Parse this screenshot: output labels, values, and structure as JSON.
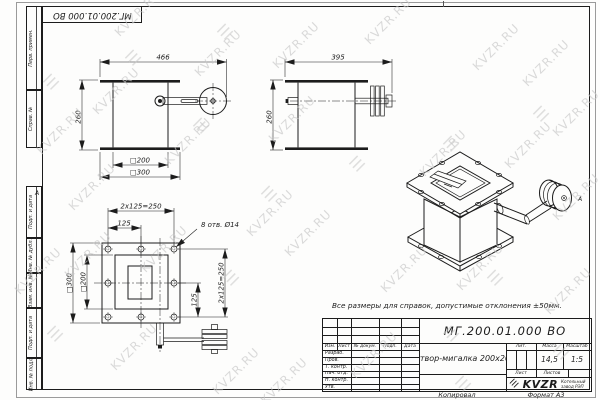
{
  "colors": {
    "line": "#1c1c1c",
    "watermark": "#c7c7c7",
    "paper": "#fdfdfc"
  },
  "watermarks": {
    "text": "KVZR.RU",
    "logo_glyph": "☰",
    "items": [
      {
        "t": "text",
        "x": 30,
        "y": 124
      },
      {
        "t": "text",
        "x": 108,
        "y": 6
      },
      {
        "t": "text",
        "x": 86,
        "y": 84
      },
      {
        "t": "text",
        "x": 158,
        "y": 134
      },
      {
        "t": "text",
        "x": 188,
        "y": 46
      },
      {
        "t": "text",
        "x": 266,
        "y": 38
      },
      {
        "t": "text",
        "x": 262,
        "y": 112
      },
      {
        "t": "text",
        "x": 358,
        "y": 14
      },
      {
        "t": "text",
        "x": 466,
        "y": 40
      },
      {
        "t": "text",
        "x": 516,
        "y": 56
      },
      {
        "t": "text",
        "x": 413,
        "y": 146
      },
      {
        "t": "text",
        "x": 498,
        "y": 138
      },
      {
        "t": "text",
        "x": 62,
        "y": 180
      },
      {
        "t": "text",
        "x": 8,
        "y": 264
      },
      {
        "t": "text",
        "x": 58,
        "y": 248
      },
      {
        "t": "text",
        "x": 134,
        "y": 242
      },
      {
        "t": "text",
        "x": 240,
        "y": 206
      },
      {
        "t": "text",
        "x": 278,
        "y": 226
      },
      {
        "t": "text",
        "x": 374,
        "y": 262
      },
      {
        "t": "text",
        "x": 450,
        "y": 260
      },
      {
        "t": "text",
        "x": 538,
        "y": 284
      },
      {
        "t": "text",
        "x": 104,
        "y": 340
      },
      {
        "t": "text",
        "x": 206,
        "y": 364
      },
      {
        "t": "text",
        "x": 254,
        "y": 374
      },
      {
        "t": "text",
        "x": 344,
        "y": 348
      },
      {
        "t": "text",
        "x": 546,
        "y": 190
      },
      {
        "t": "text",
        "x": 546,
        "y": 106
      },
      {
        "t": "logo",
        "x": 44,
        "y": 72
      },
      {
        "t": "logo",
        "x": 126,
        "y": 48
      },
      {
        "t": "logo",
        "x": 218,
        "y": 22
      },
      {
        "t": "logo",
        "x": 194,
        "y": 116
      },
      {
        "t": "logo",
        "x": 350,
        "y": 154
      },
      {
        "t": "logo",
        "x": 444,
        "y": 134
      },
      {
        "t": "logo",
        "x": 534,
        "y": 104
      },
      {
        "t": "logo",
        "x": 224,
        "y": 268
      },
      {
        "t": "logo",
        "x": 262,
        "y": 184
      },
      {
        "t": "logo",
        "x": 48,
        "y": 324
      },
      {
        "t": "logo",
        "x": 488,
        "y": 268
      },
      {
        "t": "logo",
        "x": 444,
        "y": 324
      },
      {
        "t": "logo",
        "x": 456,
        "y": 374
      },
      {
        "t": "logo",
        "x": 554,
        "y": 342
      }
    ]
  },
  "margin": {
    "zone_letter": "А",
    "items": [
      {
        "label": "Перв. примен."
      },
      {
        "label": "Справ. №"
      },
      {
        "label": "Подп. и дата"
      },
      {
        "label": "Инв. № дубл."
      },
      {
        "label": "Взам. инв. №"
      },
      {
        "label": "Подп. и дата"
      },
      {
        "label": "Инв. № подл."
      }
    ]
  },
  "corner_box": {
    "designation": "МГ.200.01.000 ВО"
  },
  "note": "Все размеры для справок, допустимые отклонения ±50мм.",
  "views": {
    "front": {
      "dim_total_width": "466",
      "dim_height": "260",
      "dim_inner": "□200",
      "dim_outer": "□300"
    },
    "side": {
      "dim_total_width": "395",
      "dim_height": "260"
    },
    "flange": {
      "dim_bolt_row": "2x125=250",
      "dim_bolt_half": "125",
      "holes_note": "8 отв. Ø14",
      "dim_outer": "□300",
      "dim_inner": "□200",
      "dim_bolt_half_v": "125",
      "dim_bolt_col": "2x125=250"
    }
  },
  "title_block": {
    "designation": "МГ.200.01.000 ВО",
    "name": "Затвор-мигалка 200x200",
    "columns": {
      "izm": "Изм.",
      "list": "Лист",
      "doc": "№ докум.",
      "sign": "Подп.",
      "date": "Дата"
    },
    "rows": [
      {
        "label": "Разраб."
      },
      {
        "label": "Пров."
      },
      {
        "label": "Т. контр."
      },
      {
        "label": "Нач. отд."
      },
      {
        "label": "Н. контр."
      },
      {
        "label": "Утв."
      }
    ],
    "lit_label": "Лит.",
    "mass_label": "Масса",
    "scale_label": "Масштаб",
    "mass_value": "14,5",
    "scale_value": "1:5",
    "sheet_label": "Лист",
    "sheets_label": "Листов",
    "company": {
      "logo_text": "KVZR",
      "name_line1": "Котельный",
      "name_line2": "завод РЭП"
    },
    "footer": {
      "copied": "Копировал",
      "format": "Формат А3"
    }
  }
}
